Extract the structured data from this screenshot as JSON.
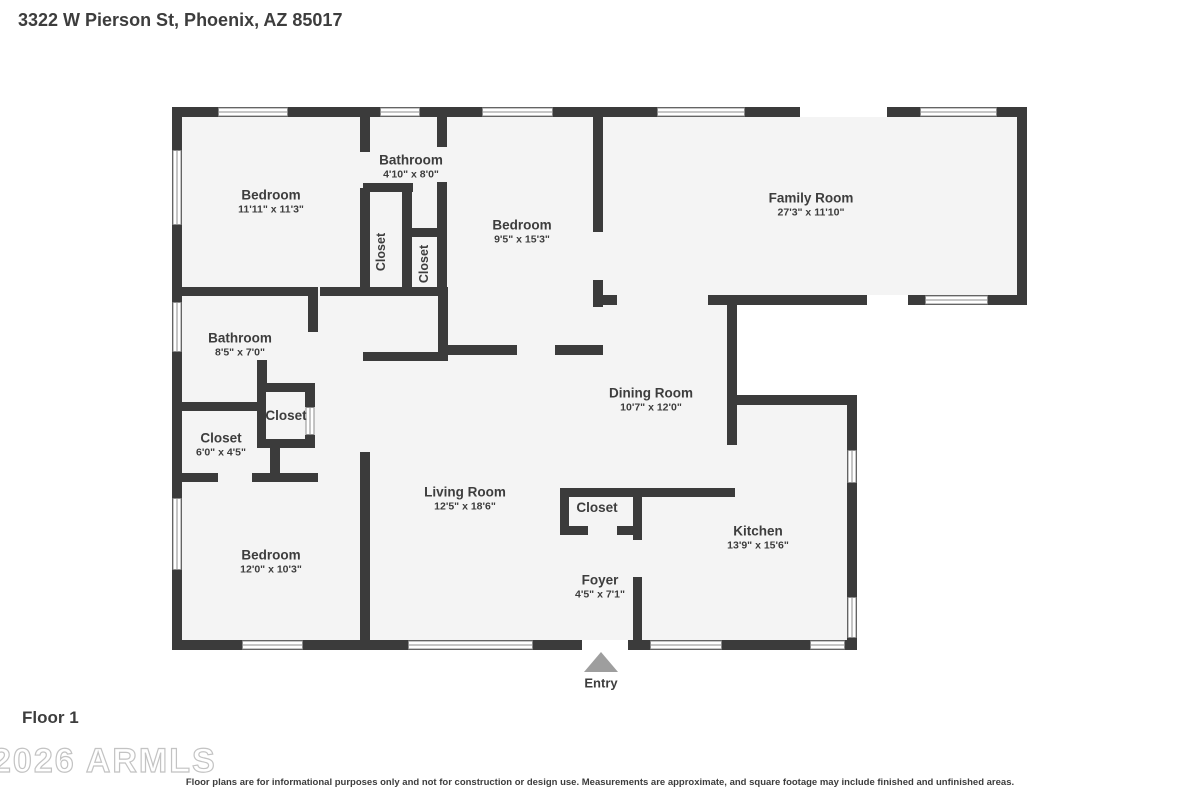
{
  "header": {
    "address": "3322 W Pierson St, Phoenix, AZ 85017"
  },
  "floor": {
    "label": "Floor 1"
  },
  "watermark": {
    "text": "2026 ARMLS"
  },
  "disclaimer": "Floor plans are for informational purposes only and not for construction or design use. Measurements are approximate, and square footage may include finished and unfinished areas.",
  "entry": {
    "label": "Entry",
    "icon": "up-triangle"
  },
  "rooms": {
    "bedroom_nw": {
      "name": "Bedroom",
      "dims": "11'11\" x 11'3\""
    },
    "bathroom_n": {
      "name": "Bathroom",
      "dims": "4'10\" x 8'0\""
    },
    "closet_n1": {
      "name": "Closet"
    },
    "closet_n2": {
      "name": "Closet"
    },
    "bedroom_n": {
      "name": "Bedroom",
      "dims": "9'5\" x 15'3\""
    },
    "family_room": {
      "name": "Family Room",
      "dims": "27'3\" x 11'10\""
    },
    "bathroom_w": {
      "name": "Bathroom",
      "dims": "8'5\" x 7'0\""
    },
    "closet_mid": {
      "name": "Closet"
    },
    "closet_w": {
      "name": "Closet",
      "dims": "6'0\" x 4'5\""
    },
    "dining_room": {
      "name": "Dining Room",
      "dims": "10'7\" x 12'0\""
    },
    "living_room": {
      "name": "Living Room",
      "dims": "12'5\" x 18'6\""
    },
    "closet_foyer": {
      "name": "Closet"
    },
    "kitchen": {
      "name": "Kitchen",
      "dims": "13'9\" x 15'6\""
    },
    "bedroom_sw": {
      "name": "Bedroom",
      "dims": "12'0\" x 10'3\""
    },
    "foyer": {
      "name": "Foyer",
      "dims": "4'5\" x 7'1\""
    }
  },
  "colors": {
    "wall": "#3b3b3b",
    "room_fill": "#f4f4f4",
    "text": "#3d3d3d",
    "entry_arrow": "#9e9e9e",
    "window_stroke": "#8c8c8c"
  }
}
